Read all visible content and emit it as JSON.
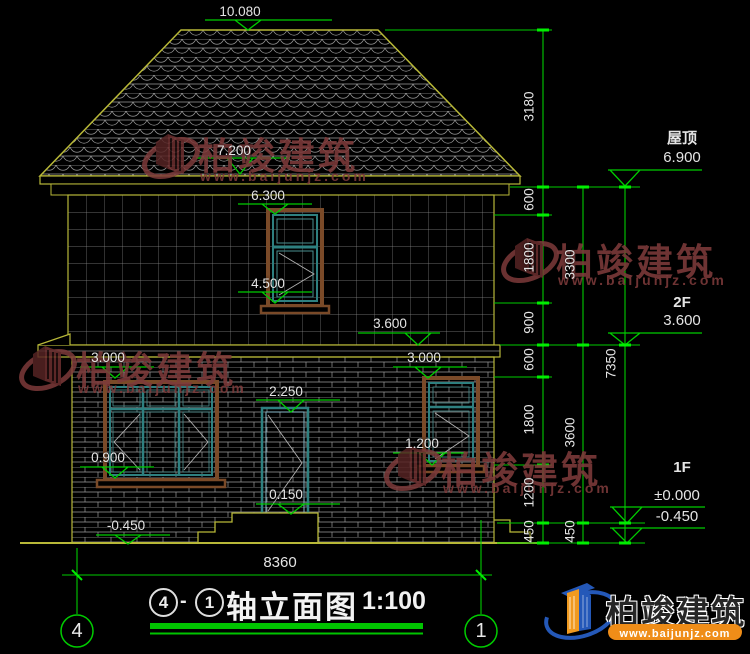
{
  "levels": {
    "ridge": "10.080",
    "eaves": "7.200",
    "win2f_top": "6.300",
    "win2f_sill": "4.500",
    "floor2_band": "3.600",
    "win1f_left_top": "3.000",
    "win1f_right_top": "3.000",
    "door_top": "2.250",
    "win1f_right_sill": "1.200",
    "win1f_left_sill": "0.900",
    "door_sill": "0.150",
    "grade_left": "-0.450"
  },
  "right_annotations": {
    "roof_label": "屋顶",
    "roof_level": "6.900",
    "floor2_label": "2F",
    "floor2_level": "3.600",
    "floor1_label": "1F",
    "floor1_level": "±0.000",
    "grade_level": "-0.450"
  },
  "dim_chain_inner": [
    "3180",
    "600",
    "1800",
    "900",
    "600",
    "1800",
    "1200",
    "450"
  ],
  "dim_chain_middle": [
    "3300",
    "3600",
    "450"
  ],
  "dim_total_height": "7350",
  "dim_total_width": "8360",
  "grid_bubbles": {
    "left": "4",
    "right": "1"
  },
  "title_bar": {
    "circle_from": "4",
    "separator": "-",
    "circle_to": "1",
    "name": "轴立面图",
    "scale": "1:100"
  },
  "watermark": {
    "brand": "柏竣建筑",
    "url": "www.baijunjz.com"
  },
  "logo": {
    "brand": "柏竣建筑",
    "url": "www.baijunjz.com"
  },
  "colors": {
    "cad_green": "#00cc00",
    "outline_yellow": "#b8b838",
    "frame_brown": "#7a4a28",
    "frame_teal": "#2e8080",
    "watermark_red": "#7d3a3a"
  }
}
